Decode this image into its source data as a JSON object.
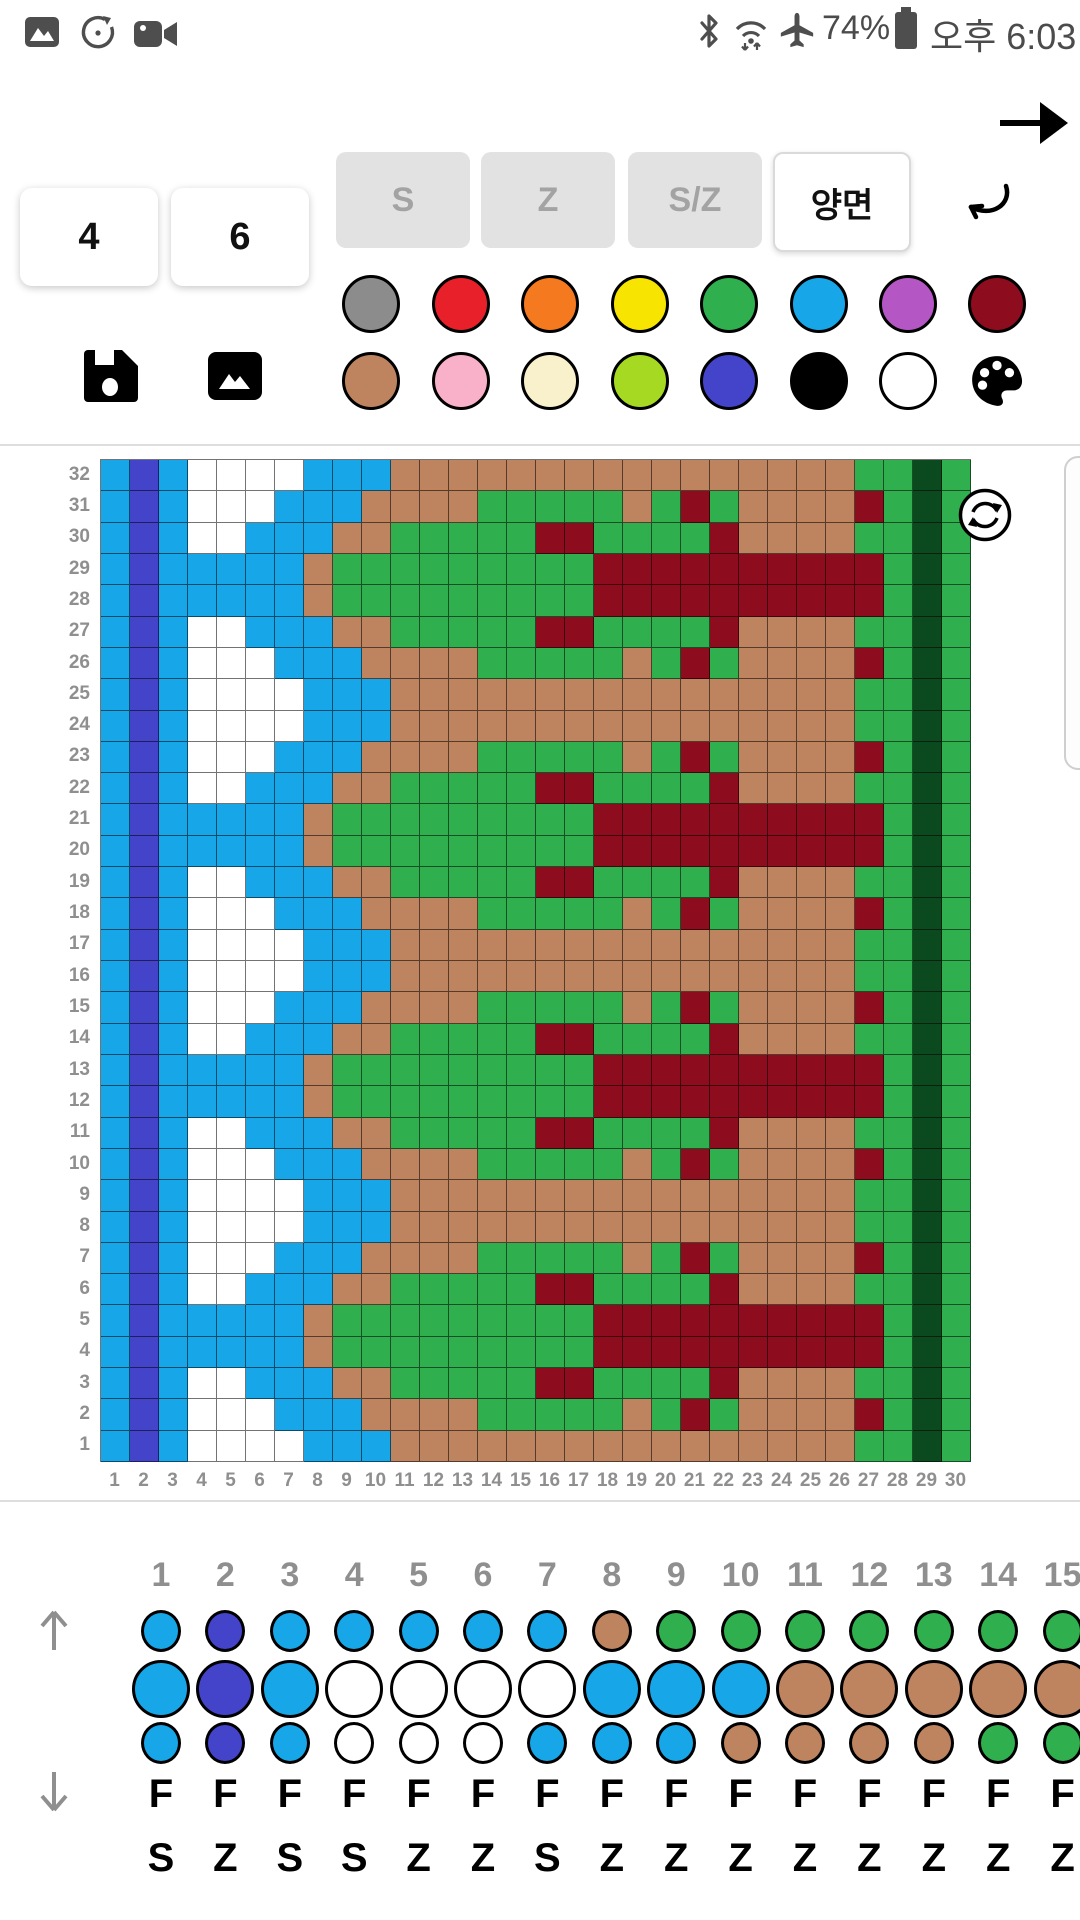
{
  "status_bar": {
    "time": "오후 6:03",
    "battery_percent": "74%",
    "left_icons": [
      "gallery-icon",
      "timer-icon",
      "video-icon"
    ],
    "right_icons": [
      "bluetooth-icon",
      "wifi-icon",
      "airplane-icon",
      "battery-icon"
    ]
  },
  "toolbar": {
    "stitch_count_1": "4",
    "stitch_count_2": "6",
    "mode_buttons": [
      {
        "label": "S",
        "state": "inactive"
      },
      {
        "label": "Z",
        "state": "inactive"
      },
      {
        "label": "S/Z",
        "state": "inactive"
      },
      {
        "label": "양면",
        "state": "active"
      }
    ],
    "accent_black": "#000000"
  },
  "palette": {
    "row1": [
      "#8C8C8C",
      "#E8202A",
      "#F4791F",
      "#F7E400",
      "#2FAF4E",
      "#17A7E9",
      "#B457C4",
      "#8D0C1E"
    ],
    "row2": [
      "#BE8460",
      "#F9B1C9",
      "#F9F1CB",
      "#A6DA22",
      "#4444CB",
      "#000000",
      "#FFFFFF",
      "palette-icon"
    ]
  },
  "chart_data": {
    "type": "heatmap",
    "title": "Knitting / bead loom color chart, 30 columns x 32 rows",
    "legend_position": "none",
    "grid_on": true,
    "color_key": {
      "B": "#17A7E9",
      "I": "#4444CB",
      "W": "#FFFFFF",
      "T": "#BE8460",
      "G": "#2FAF4E",
      "R": "#8D0C1E",
      "D": "#0B4A1E"
    },
    "row_labels": [
      "32",
      "31",
      "30",
      "29",
      "28",
      "27",
      "26",
      "25",
      "24",
      "23",
      "22",
      "21",
      "20",
      "19",
      "18",
      "17",
      "16",
      "15",
      "14",
      "13",
      "12",
      "11",
      "10",
      "9",
      "8",
      "7",
      "6",
      "5",
      "4",
      "3",
      "2",
      "1"
    ],
    "column_labels": [
      "1",
      "2",
      "3",
      "4",
      "5",
      "6",
      "7",
      "8",
      "9",
      "10",
      "11",
      "12",
      "13",
      "14",
      "15",
      "16",
      "17",
      "18",
      "19",
      "20",
      "21",
      "22",
      "23",
      "24",
      "25",
      "26",
      "27",
      "28",
      "29",
      "30"
    ],
    "cells": [
      "BIBWWWWBBBTTTTTTTTTTTTTTTTGGDG",
      "BIBWWWBBBTTTTGGGGGTGRGTTTTRGDG",
      "BIBWWBBBTTGGGGGRRGGGGRTTTTGGDG",
      "BIBBBBBTGGGGGGGGGRRRRRRRRRRGDG",
      "BIBBBBBTGGGGGGGGGRRRRRRRRRRGDG",
      "BIBWWBBBTTGGGGGRRGGGGRTTTTGGDG",
      "BIBWWWBBBTTTTGGGGGTGRGTTTTRGDG",
      "BIBWWWWBBBTTTTTTTTTTTTTTTTGGDG",
      "BIBWWWWBBBTTTTTTTTTTTTTTTTGGDG",
      "BIBWWWBBBTTTTGGGGGTGRGTTTTRGDG",
      "BIBWWBBBTTGGGGGRRGGGGRTTTTGGDG",
      "BIBBBBBTGGGGGGGGGRRRRRRRRRRGDG",
      "BIBBBBBTGGGGGGGGGRRRRRRRRRRGDG",
      "BIBWWBBBTTGGGGGRRGGGGRTTTTGGDG",
      "BIBWWWBBBTTTTGGGGGTGRGTTTTRGDG",
      "BIBWWWWBBBTTTTTTTTTTTTTTTTGGDG",
      "BIBWWWWBBBTTTTTTTTTTTTTTTTGGDG",
      "BIBWWWBBBTTTTGGGGGTGRGTTTTRGDG",
      "BIBWWBBBTTGGGGGRRGGGGRTTTTGGDG",
      "BIBBBBBTGGGGGGGGGRRRRRRRRRRGDG",
      "BIBBBBBTGGGGGGGGGRRRRRRRRRRGDG",
      "BIBWWBBBTTGGGGGRRGGGGRTTTTGGDG",
      "BIBWWWBBBTTTTGGGGGTGRGTTTTRGDG",
      "BIBWWWWBBBTTTTTTTTTTTTTTTTGGDG",
      "BIBWWWWBBBTTTTTTTTTTTTTTTTGGDG",
      "BIBWWWBBBTTTTGGGGGTGRGTTTTRGDG",
      "BIBWWBBBTTGGGGGRRGGGGRTTTTGGDG",
      "BIBBBBBTGGGGGGGGGRRRRRRRRRRGDG",
      "BIBBBBBTGGGGGGGGGRRRRRRRRRRGDG",
      "BIBWWBBBTTGGGGGRRGGGGRTTTTGGDG",
      "BIBWWWBBBTTTTGGGGGTGRGTTTTRGDG",
      "BIBWWWWBBBTTTTTTTTTTTTTTTTGGDG"
    ]
  },
  "bottom_panel": {
    "column_numbers": [
      "1",
      "2",
      "3",
      "4",
      "5",
      "6",
      "7",
      "8",
      "9",
      "10",
      "11",
      "12",
      "13",
      "14",
      "15"
    ],
    "bead_rows": [
      {
        "size": "small",
        "colors": "BIBBBBBTGGGGGGG"
      },
      {
        "size": "large",
        "colors": "BIBWWWWBBBTTTTT"
      },
      {
        "size": "small",
        "colors": "BIBWWWBBBTTTTGG"
      }
    ],
    "f_labels": [
      "F",
      "F",
      "F",
      "F",
      "F",
      "F",
      "F",
      "F",
      "F",
      "F",
      "F",
      "F",
      "F",
      "F",
      "F"
    ],
    "twist_labels": [
      "S",
      "Z",
      "S",
      "S",
      "Z",
      "Z",
      "S",
      "Z",
      "Z",
      "Z",
      "Z",
      "Z",
      "Z",
      "Z",
      "Z"
    ]
  }
}
